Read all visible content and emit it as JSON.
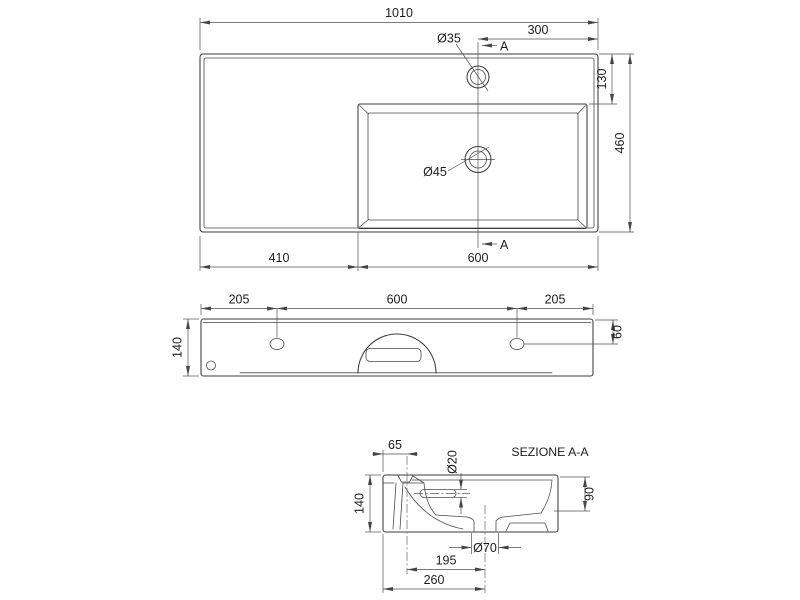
{
  "drawing": {
    "top_view": {
      "overall_width": "1010",
      "tap_offset": "300",
      "tap_hole_dia": "Ø35",
      "section_marker_top": "A",
      "back_ledge_depth": "130",
      "overall_depth": "460",
      "drain_dia": "Ø45",
      "ledge_width": "410",
      "basin_width": "600",
      "section_marker_bottom": "A"
    },
    "front_view": {
      "hole_offset_left": "205",
      "hole_spacing": "600",
      "hole_offset_right": "205",
      "overall_height": "140",
      "hole_drop": "60"
    },
    "section_view": {
      "title": "SEZIONE A-A",
      "tap_center_offset": "65",
      "overflow_dia": "Ø20",
      "basin_depth": "90",
      "overall_height": "140",
      "drain_outlet_dia": "Ø70",
      "drain_offset": "195",
      "drain_offset_total": "260"
    }
  }
}
